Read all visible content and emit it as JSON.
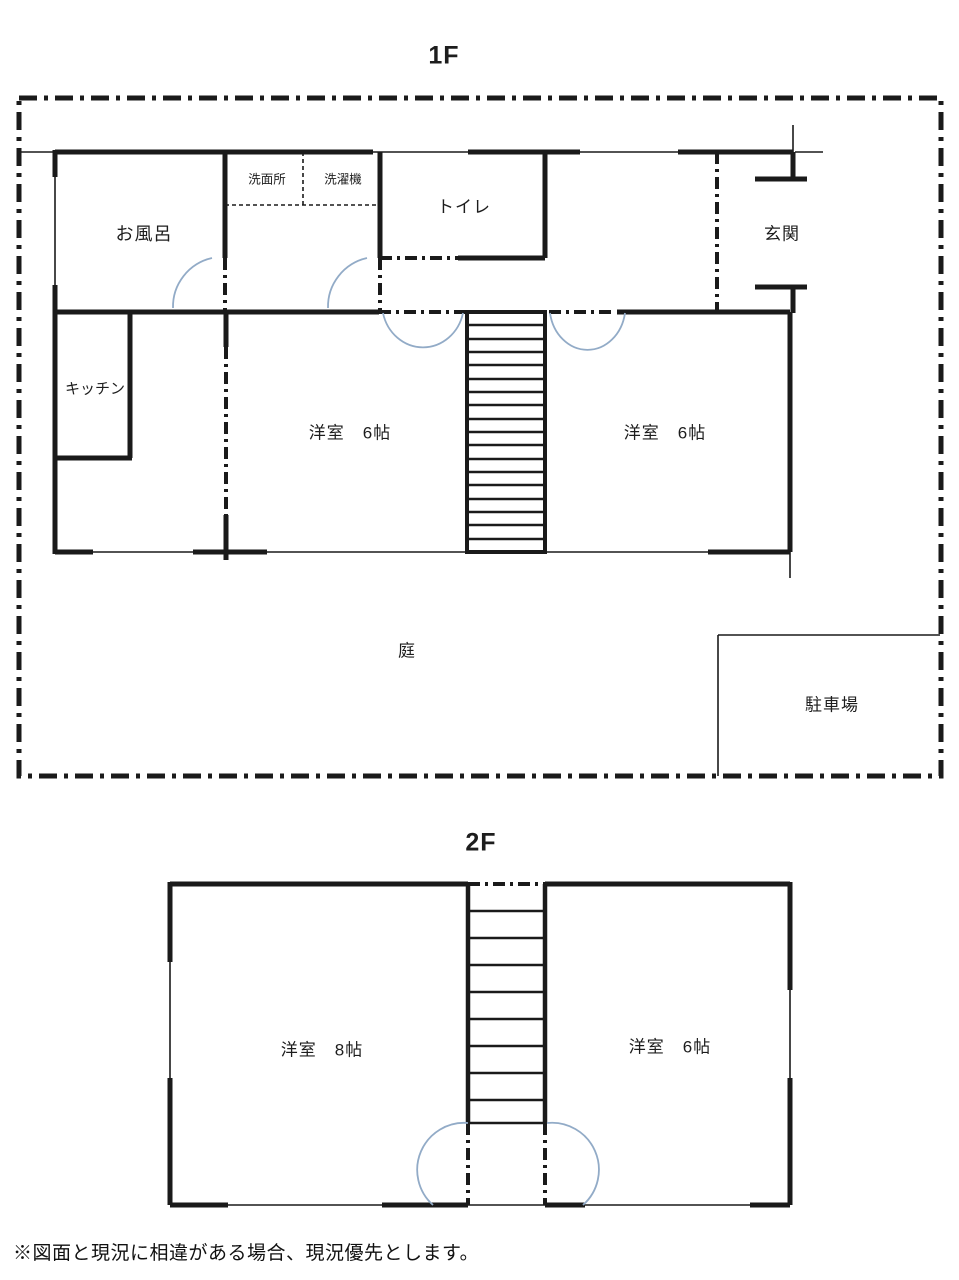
{
  "colors": {
    "line": "#1a1a1a",
    "door_arc": "#92abc7",
    "background": "#ffffff"
  },
  "floor1": {
    "title": "1F",
    "labels": {
      "bath": "お風呂",
      "washroom": "洗面所",
      "laundry": "洗濯機",
      "toilet": "トイレ",
      "entrance": "玄関",
      "kitchen": "キッチン",
      "room_left": "洋室　6帖",
      "room_right": "洋室　6帖",
      "garden": "庭",
      "parking": "駐車場"
    }
  },
  "floor2": {
    "title": "2F",
    "labels": {
      "room_left": "洋室　8帖",
      "room_right": "洋室　6帖"
    }
  },
  "note": "※図面と現況に相違がある場合、現況優先とします。"
}
